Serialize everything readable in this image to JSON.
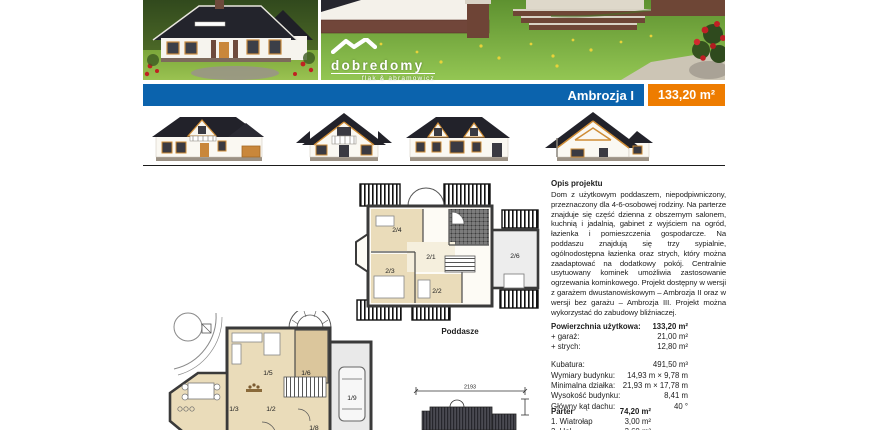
{
  "title_bar": {
    "project_name": "Ambrozja I",
    "area": "133,20 m²"
  },
  "logo": {
    "brand": "dobredomy",
    "tagline": "flak & abramowicz",
    "icon": "roof-icon"
  },
  "colors": {
    "bar_blue": "#0b63ad",
    "badge_orange": "#ee7c00",
    "room_tan": "#eadcba",
    "accent_orange": "#cf8c35"
  },
  "description": {
    "heading": "Opis projektu",
    "body": "Dom z użytkowym poddaszem, niepodpiwniczony, przeznaczony dla 4-6-osobowej rodziny. Na parterze znajduje się część dzienna z obszernym salonem, kuchnią i jadalnią, gabinet z wyjściem na ogród, łazienka i pomieszczenia gospodarcze. Na poddaszu znajdują się trzy sypialnie, ogólnodostępna łazienka oraz strych, który można zaadaptować na dodatkowy pokój. Centralnie usytuowany kominek umożliwia zastosowanie ogrzewania kominkowego. Projekt dostępny w wersji z garażem dwustanowiskowym – Ambrozja II oraz w wersji bez garażu – Ambrozja III. Projekt można wykorzystać do zabudowy bliźniaczej."
  },
  "specs": {
    "rows": [
      {
        "label": "Powierzchnia użytkowa:",
        "value": "133,20 m²"
      },
      {
        "label": "+ garaż:",
        "value": "21,00 m²"
      },
      {
        "label": "+ strych:",
        "value": "12,80 m²"
      }
    ],
    "rows2": [
      {
        "label": "Kubatura:",
        "value": "491,50 m³"
      },
      {
        "label": "Wymiary budynku:",
        "value": "14,93 m × 9,78 m"
      },
      {
        "label": "Minimalna działka:",
        "value": "21,93 m × 17,78 m"
      },
      {
        "label": "Wysokość budynku:",
        "value": "8,41 m"
      },
      {
        "label": "Główny kąt dachu:",
        "value": "40 °"
      }
    ]
  },
  "room_list": {
    "heading": "Parter",
    "heading_value": "74,20 m²",
    "rows": [
      {
        "label": "1. Wiatrołap",
        "value": "3,00 m²"
      },
      {
        "label": "2. Hol",
        "value": "3,60 m²"
      }
    ]
  },
  "plans": {
    "poddasze": {
      "caption": "Poddasze",
      "labels": {
        "r21": "2/1",
        "r22": "2/2",
        "r23": "2/3",
        "r24": "2/4",
        "r26": "2/6"
      }
    },
    "parter": {
      "labels": {
        "r12": "1/2",
        "r13": "1/3",
        "r15": "1/5",
        "r16": "1/6",
        "r18": "1/8",
        "r19": "1/9"
      }
    },
    "roof_plan": {
      "width_dim": "2193"
    }
  }
}
